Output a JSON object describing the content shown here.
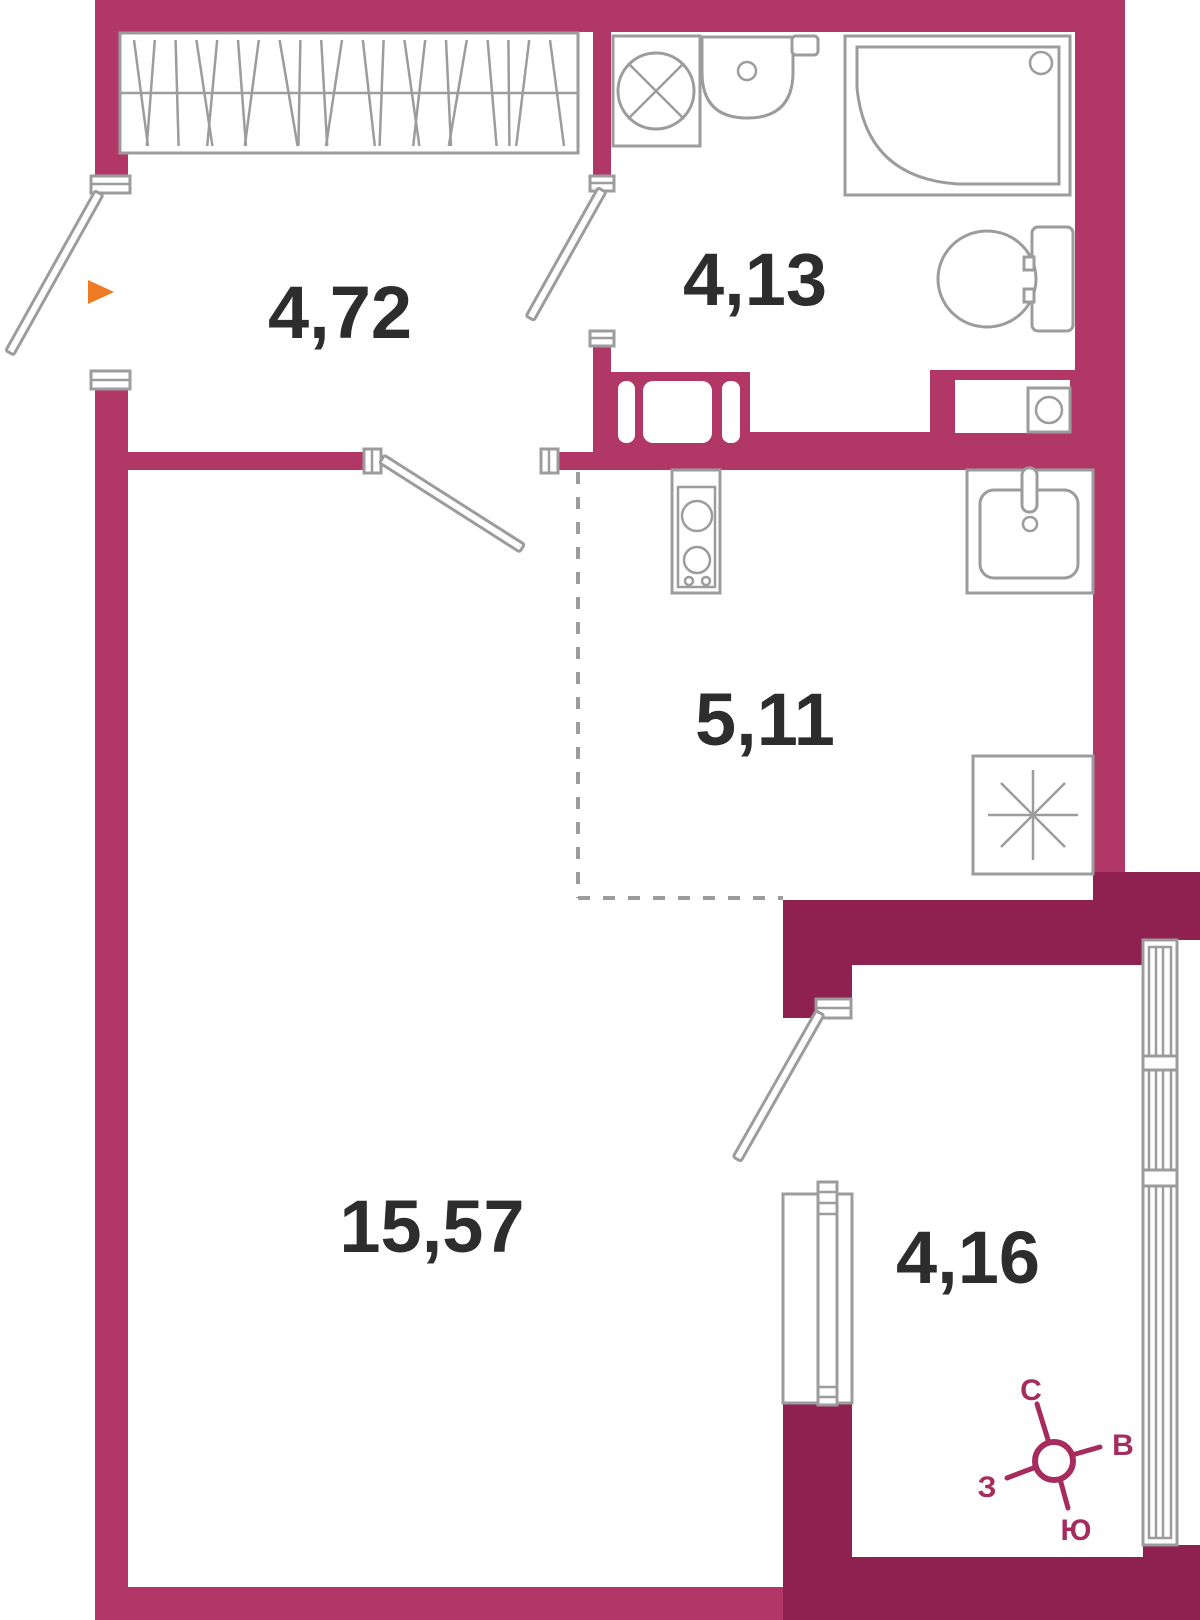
{
  "plan": {
    "rooms": {
      "hallway": {
        "area_label": "4,72"
      },
      "bathroom": {
        "area_label": "4,13"
      },
      "kitchen": {
        "area_label": "5,11"
      },
      "living_room": {
        "area_label": "15,57"
      },
      "balcony": {
        "area_label": "4,16"
      }
    },
    "compass": {
      "north_label": "С",
      "east_label": "В",
      "west_label": "З",
      "south_label": "Ю"
    },
    "icons": [
      "wardrobe-icon",
      "washing-machine-icon",
      "washbasin-icon",
      "shower-icon",
      "toilet-icon",
      "stove-icon",
      "kitchen-sink-icon",
      "fridge-icon",
      "window-icon",
      "balcony-door-icon",
      "entrance-arrow-icon",
      "compass-icon"
    ],
    "colors": {
      "wall_primary": "#b13767",
      "wall_secondary": "#8e2150",
      "fixture_line": "#9c9c9c",
      "label_text": "#2d2d2d",
      "entrance_arrow": "#ee7a23",
      "compass": "#a62c5e"
    }
  }
}
